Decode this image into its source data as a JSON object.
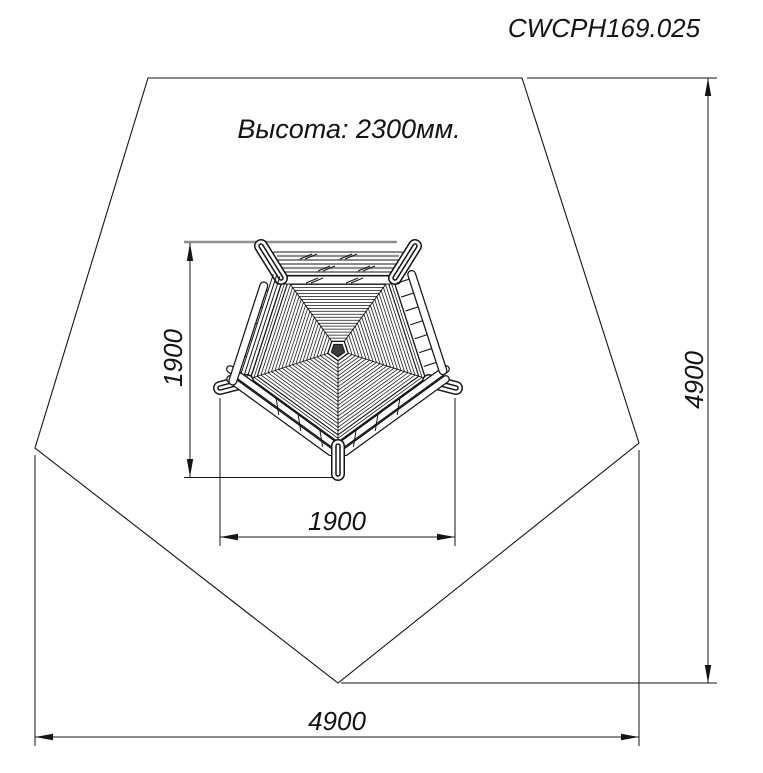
{
  "drawing": {
    "title": "CWCPH169.025",
    "height_note": "Высота: 2300мм.",
    "dimensions": {
      "safety_zone_width_mm": "4900",
      "safety_zone_depth_mm": "4900",
      "unit_width_mm": "1900",
      "unit_depth_mm": "1900"
    },
    "colors": {
      "line": "#141414",
      "gray_reference": "#8f8f8f",
      "background": "#ffffff",
      "roof_center_fill": "#3c3c3c"
    }
  }
}
